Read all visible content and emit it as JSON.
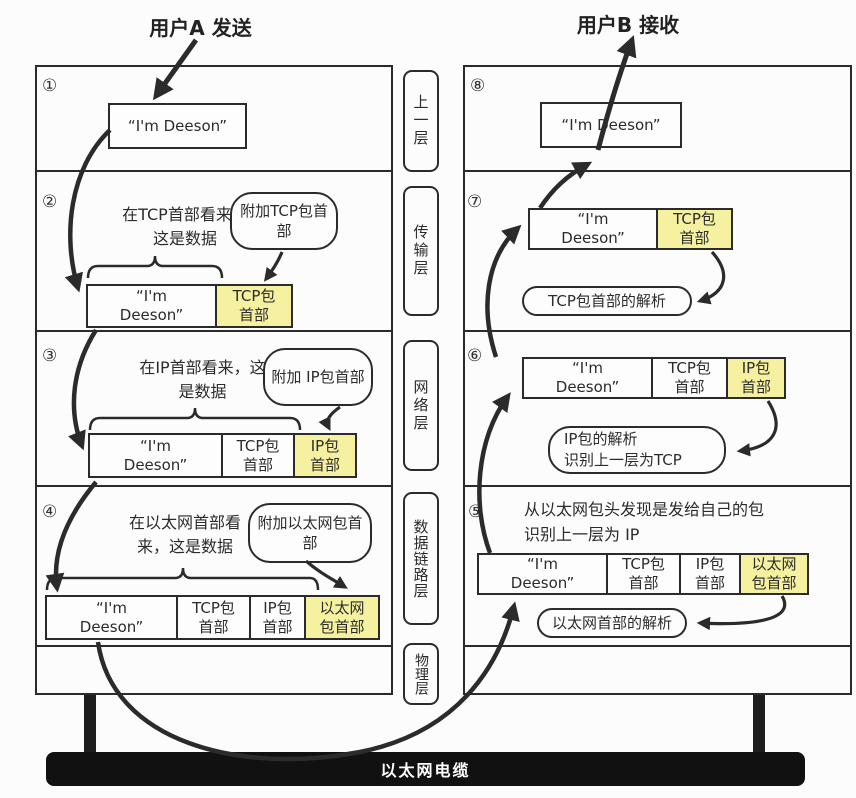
{
  "titles": {
    "sender": "用户A 发送",
    "receiver": "用户B 接收"
  },
  "steps": {
    "s1": "①",
    "s2": "②",
    "s3": "③",
    "s4": "④",
    "s5": "⑤",
    "s6": "⑥",
    "s7": "⑦",
    "s8": "⑧"
  },
  "layers": {
    "upper": "上一层",
    "transport": "传输层",
    "network": "网络层",
    "datalink": "数据链路层",
    "physical": "物理层"
  },
  "seg": {
    "data_one": "“I'm Deeson”",
    "data1": "“I'm",
    "data2": "Deeson”",
    "tcp1": "TCP包",
    "tcp2": "首部",
    "ip1": "IP包",
    "ip2": "首部",
    "eth1": "以太网",
    "eth2": "包首部"
  },
  "left": {
    "s2": {
      "note1": "在TCP首部看来，",
      "note2": "这是数据",
      "bubble": "附加TCP包首部"
    },
    "s3": {
      "note1": "在IP首部看来，这",
      "note2": "是数据",
      "bubble": "附加 IP包首部"
    },
    "s4": {
      "note1": "在以太网首部看",
      "note2": "来，这是数据",
      "bubble": "附加以太网包首部"
    }
  },
  "right": {
    "s5": {
      "note1": "从以太网包头发现是发给自己的包",
      "note2": "识别上一层为 IP",
      "bubble": "以太网首部的解析"
    },
    "s6": {
      "bubble1": "IP包的解析",
      "bubble2": "识别上一层为TCP"
    },
    "s7": {
      "bubble": "TCP包首部的解析"
    }
  },
  "cable": {
    "label": "以太网电缆"
  },
  "colors": {
    "highlight": "#f5f1a0",
    "line": "#2b2b2b",
    "cable_bg": "#111111"
  }
}
